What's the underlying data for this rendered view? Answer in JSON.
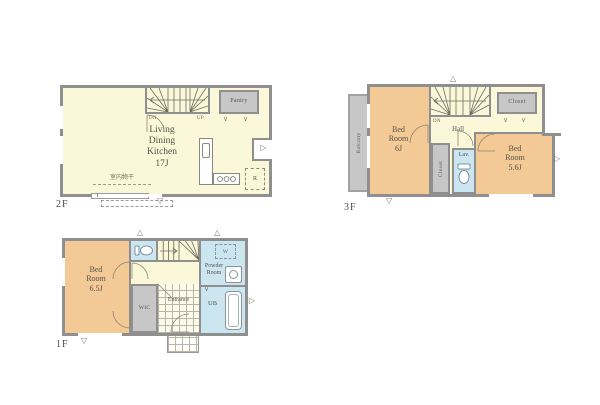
{
  "palette": {
    "wall": "#8f8f8f",
    "room": "#fbf8d9",
    "bedroom": "#f3c995",
    "wet_area": "#cbe5f1",
    "storage": "#c7c7c7",
    "text": "#55524a"
  },
  "icons": {
    "vent_down": "▽",
    "vent_up": "△",
    "vent_right": "▷",
    "fold": "∨"
  },
  "floors": {
    "f2": {
      "label": "2F",
      "ldk": "Living\nDining\nKitchen\n17J",
      "pantry": "Pantry",
      "fridge": "R",
      "indoor_drying": "室内物干",
      "dn": "DN",
      "up": "UP"
    },
    "f3": {
      "label": "3F",
      "balcony": "Balcony",
      "bedroom_left": "Bed\nRoom\n6J",
      "bedroom_right": "Bed\nRoom\n5.6J",
      "hall": "Hall",
      "dn": "DN",
      "closet_mid": "Closet",
      "closet_top": "Closet",
      "lavatory": "Lav."
    },
    "f1": {
      "label": "1F",
      "bedroom": "Bed\nRoom\n6.5J",
      "wic": "WIC",
      "entrance": "Entrance",
      "powder_room": "Powder\nRoom",
      "unit_bath": "UB",
      "washer": "W"
    }
  }
}
